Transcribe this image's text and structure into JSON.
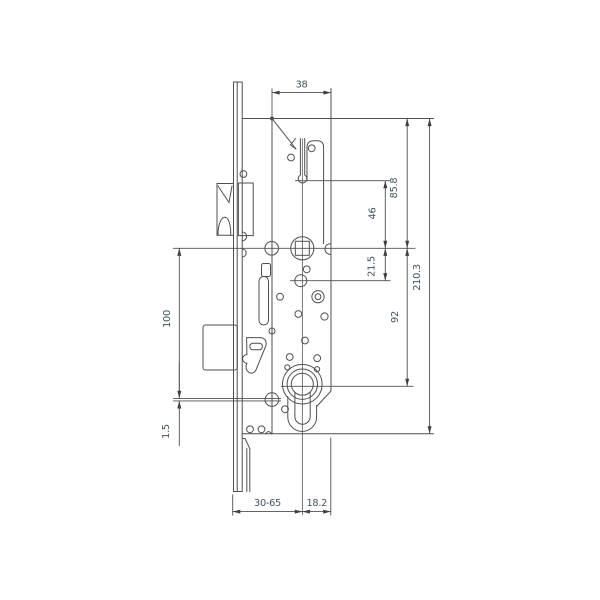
{
  "drawing": {
    "type": "technical-dimension-drawing",
    "subject": "multipoint-lock-gearbox-side-view",
    "dimensions": {
      "top_width": "38",
      "case_top_to_follower": "85.8",
      "slot_to_follower": "46",
      "follower_to_hole": "21.5",
      "total_height": "210.3",
      "follower_to_cylinder": "92",
      "faceplate_span": "100",
      "offset": "1.5",
      "backset_range": "30-65",
      "axis_to_back": "18.2"
    },
    "colors": {
      "line": "#4f4f4f",
      "dimension_text": "#3e5661",
      "background": "#ffffff"
    }
  }
}
